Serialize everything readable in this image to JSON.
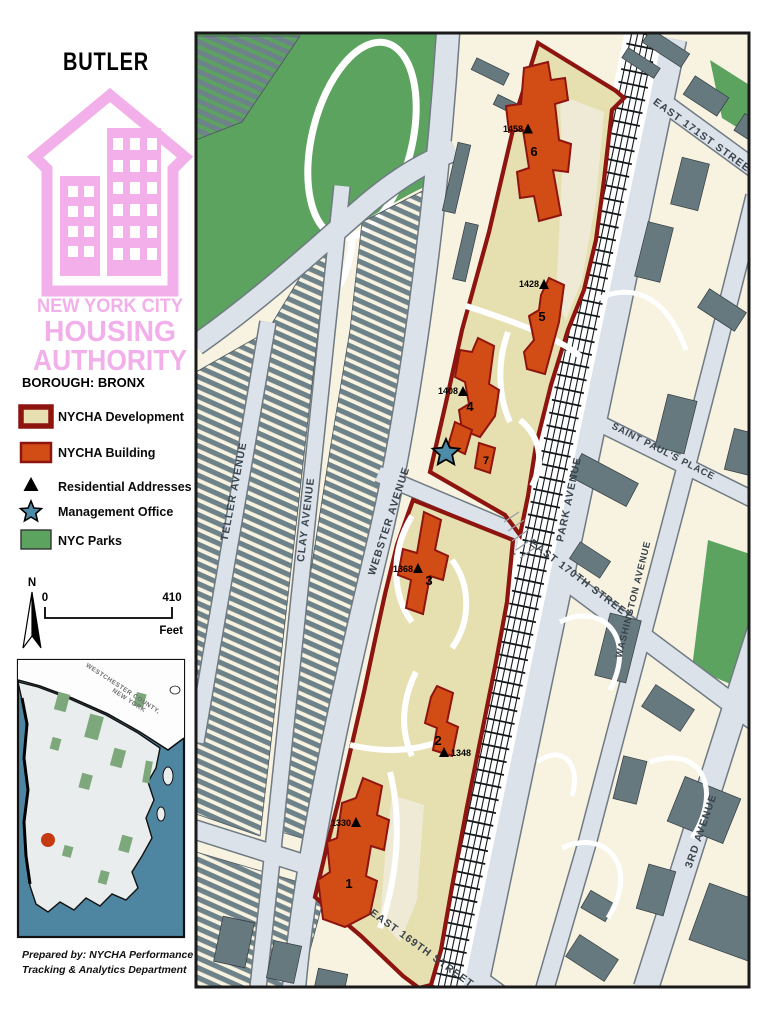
{
  "page": {
    "title": "BUTLER",
    "borough": "BOROUGH: BRONX"
  },
  "logo": {
    "line1": "NEW YORK CITY",
    "line2": "HOUSING",
    "line3": "AUTHORITY"
  },
  "legend": {
    "development": "NYCHA Development",
    "building": "NYCHA Building",
    "residential": "Residential Addresses",
    "office": "Management Office",
    "parks": "NYC Parks"
  },
  "scalebar": {
    "north": "N",
    "start": "0",
    "end": "410",
    "unit": "Feet"
  },
  "inset": {
    "county1": "WESTCHESTER COUNTY,",
    "county2": "NEW YORK"
  },
  "credits": {
    "line1": "Prepared by: NYCHA Performance",
    "line2": "Tracking & Analytics Department"
  },
  "streets": {
    "e171": "EAST 171ST STREET",
    "e170": "EAST 170TH STREET",
    "e169": "EAST 169TH STREET",
    "stpaul": "SAINT PAUL'S PLACE",
    "park": "PARK AVENUE",
    "webster": "WEBSTER AVENUE",
    "washington": "WASHINGTON AVENUE",
    "third": "3RD AVENUE",
    "clay": "CLAY AVENUE",
    "teller": "TELLER AVENUE"
  },
  "buildings": [
    {
      "number": "1",
      "address": "1330"
    },
    {
      "number": "2",
      "address": "1348"
    },
    {
      "number": "3",
      "address": "1368"
    },
    {
      "number": "4",
      "address": "1408"
    },
    {
      "number": "5",
      "address": "1428"
    },
    {
      "number": "6",
      "address": "1458"
    },
    {
      "number": "7",
      "address": ""
    }
  ],
  "colors": {
    "development_fill": "#E6DFB0",
    "building_fill": "#D24D15",
    "boundary": "#8E1410",
    "parks_green": "#5CA35F",
    "water_blue": "#4E86A2",
    "logo_pink": "#F2AFEA",
    "star_blue": "#4C8CA9",
    "road": "#DBE2EA",
    "block_cream": "#F8F3E1",
    "building_gray": "#66797F"
  }
}
